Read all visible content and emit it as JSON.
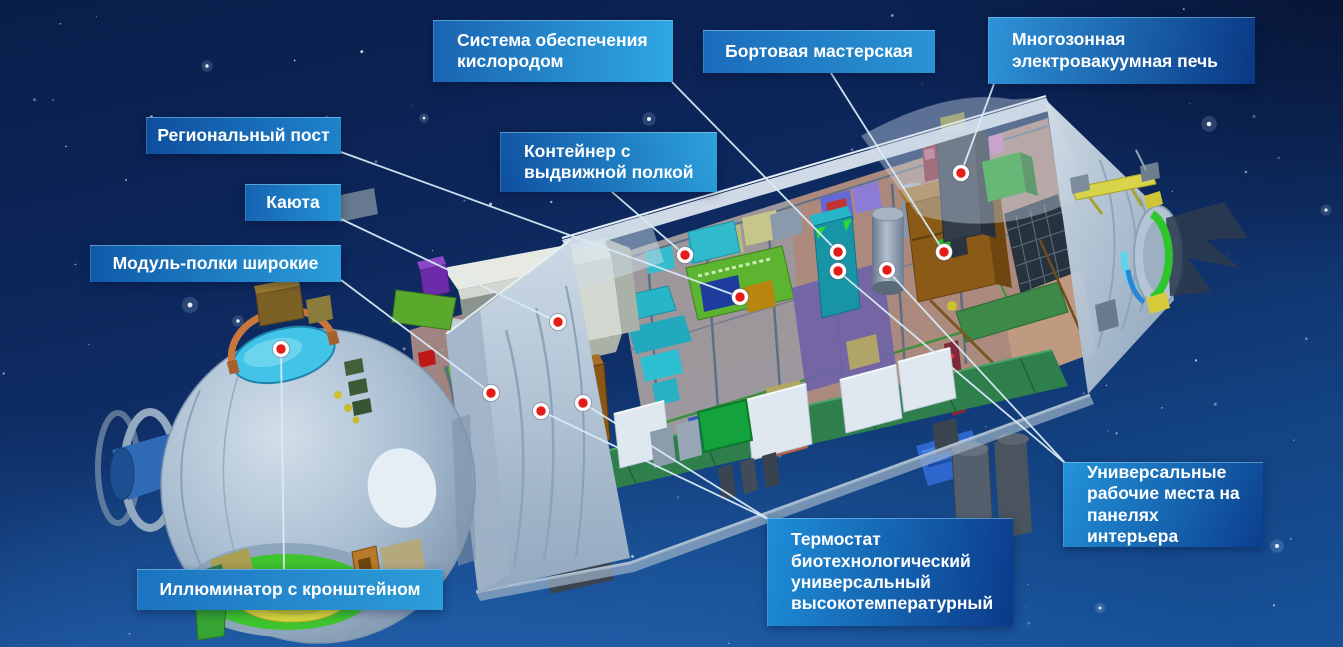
{
  "title": "Космический модуль — схема внутреннего устройства",
  "colors": {
    "background_top": "#0a1e4a",
    "background_bottom": "#175299",
    "label_text": "#ffffff",
    "leader_line": "#d9ebf7",
    "marker_fill": "#e41c17",
    "marker_ring": "#ffffff"
  },
  "callouts": [
    {
      "id": "oxygen-system",
      "label": "Система обеспечения кислородом",
      "box": {
        "x": 433,
        "y": 20,
        "w": 240,
        "h": 62
      },
      "dir": "90deg",
      "gradient": [
        "#1a64b2",
        "#2fa7e3"
      ],
      "align": "left",
      "anchor": [
        672,
        82
      ],
      "dots": [
        [
          838,
          252
        ]
      ]
    },
    {
      "id": "onboard-workshop",
      "label": "Бортовая мастерская",
      "box": {
        "x": 703,
        "y": 30,
        "w": 232,
        "h": 43
      },
      "dir": "90deg",
      "gradient": [
        "#1a6cbc",
        "#2a93d2"
      ],
      "align": "center",
      "anchor": [
        831,
        73
      ],
      "dots": [
        [
          944,
          252
        ]
      ]
    },
    {
      "id": "multizone-furnace",
      "label": "Многозонная электровакуумная печь",
      "box": {
        "x": 988,
        "y": 17,
        "w": 267,
        "h": 67
      },
      "dir": "100deg",
      "gradient": [
        "#2e93d8",
        "#0a3884"
      ],
      "align": "left",
      "anchor": [
        994,
        84
      ],
      "dots": [
        [
          961,
          173
        ]
      ]
    },
    {
      "id": "regional-post",
      "label": "Региональный пост",
      "box": {
        "x": 146,
        "y": 117,
        "w": 195,
        "h": 37
      },
      "dir": "90deg",
      "gradient": [
        "#0e4f9e",
        "#1f83cc"
      ],
      "align": "center",
      "anchor": [
        341,
        152
      ],
      "dots": [
        [
          740,
          297
        ]
      ]
    },
    {
      "id": "cabin",
      "label": "Каюта",
      "box": {
        "x": 245,
        "y": 184,
        "w": 96,
        "h": 37
      },
      "dir": "90deg",
      "gradient": [
        "#1563b2",
        "#2493d6"
      ],
      "align": "center",
      "anchor": [
        341,
        219
      ],
      "dots": [
        [
          558,
          322
        ]
      ]
    },
    {
      "id": "wide-shelves",
      "label": "Модуль-полки широкие",
      "box": {
        "x": 90,
        "y": 245,
        "w": 251,
        "h": 37
      },
      "dir": "90deg",
      "gradient": [
        "#0f5aa8",
        "#2b9ddb"
      ],
      "align": "center",
      "anchor": [
        341,
        280
      ],
      "dots": [
        [
          491,
          393
        ]
      ]
    },
    {
      "id": "container-shelf",
      "label": "Контейнер с выдвижной полкой",
      "box": {
        "x": 500,
        "y": 132,
        "w": 217,
        "h": 60
      },
      "dir": "70deg",
      "gradient": [
        "#0f4fa0",
        "#2da2de"
      ],
      "align": "left",
      "anchor": [
        612,
        192
      ],
      "dots": [
        [
          685,
          255
        ]
      ]
    },
    {
      "id": "porthole-bracket",
      "label": "Иллюминатор с кронштейном",
      "box": {
        "x": 137,
        "y": 569,
        "w": 306,
        "h": 41
      },
      "dir": "90deg",
      "gradient": [
        "#1c73c0",
        "#2d9dd8"
      ],
      "align": "center",
      "anchor": [
        284,
        569
      ],
      "dots": [
        [
          281,
          349
        ]
      ]
    },
    {
      "id": "thermostat",
      "label": "Термостат биотехнологический универсальный высокотемпературный",
      "box": {
        "x": 767,
        "y": 518,
        "w": 246,
        "h": 108
      },
      "dir": "100deg",
      "gradient": [
        "#1e8ed8",
        "#0b3a8a"
      ],
      "align": "left",
      "anchor": [
        770,
        520
      ],
      "dots": [
        [
          541,
          411
        ],
        [
          583,
          403
        ]
      ]
    },
    {
      "id": "universal-workplaces",
      "label": "Универсальные рабочие места на панелях интерьера",
      "box": {
        "x": 1063,
        "y": 462,
        "w": 200,
        "h": 85
      },
      "dir": "115deg",
      "gradient": [
        "#2394da",
        "#0b3e8e"
      ],
      "align": "left",
      "anchor": [
        1066,
        464
      ],
      "dots": [
        [
          838,
          271
        ],
        [
          887,
          270
        ]
      ]
    }
  ]
}
